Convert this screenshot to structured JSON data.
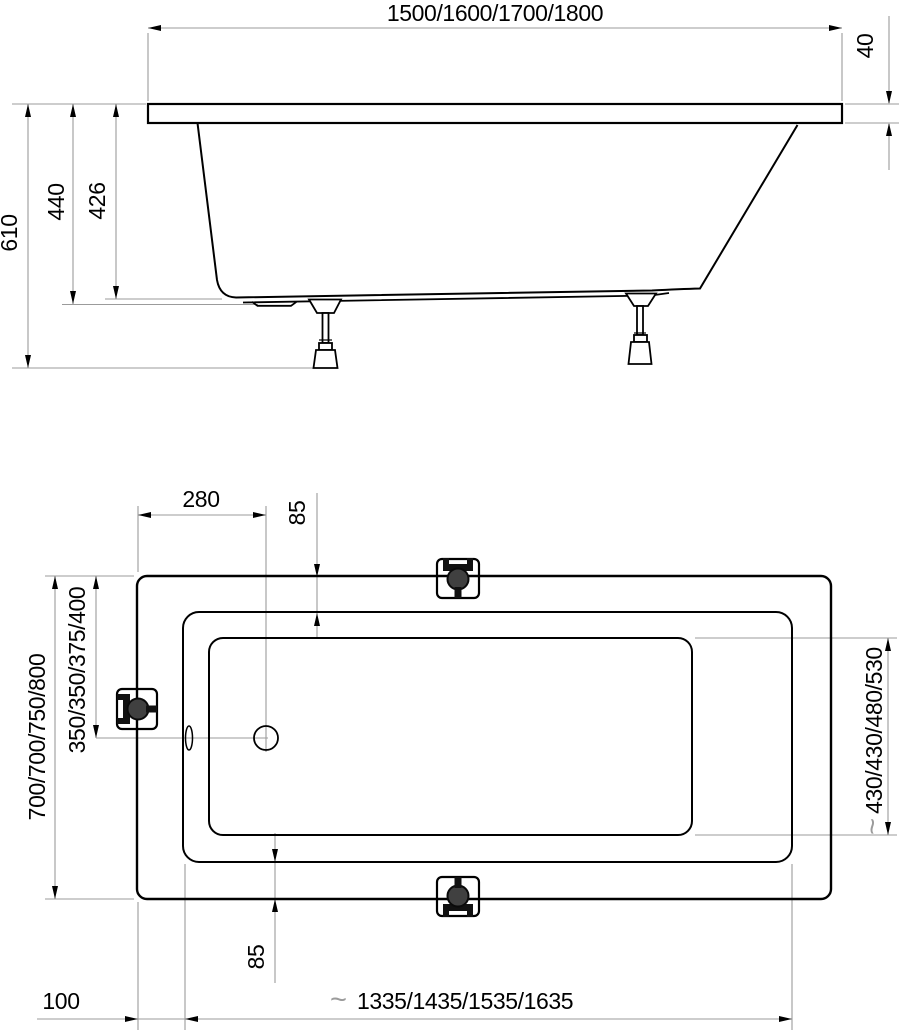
{
  "approx": "~",
  "side_view": {
    "length": "1500/1600/1700/1800",
    "rim_height": "40",
    "overall_height": "610",
    "depth_outer": "440",
    "depth_inner": "426"
  },
  "top_view": {
    "drain_from_left": "280",
    "rim_top": "85",
    "overall_width": "700/700/750/800",
    "drain_from_top": "350/350/375/400",
    "bottom_width": "430/430/480/530",
    "rim_bottom": "85",
    "left_offset": "100",
    "bottom_length": "1335/1435/1535/1635"
  },
  "colors": {
    "outline": "#000000",
    "dimension_line": "#9b9b9b",
    "fixture_dark": "#111111",
    "fixture_mid": "#404040"
  }
}
